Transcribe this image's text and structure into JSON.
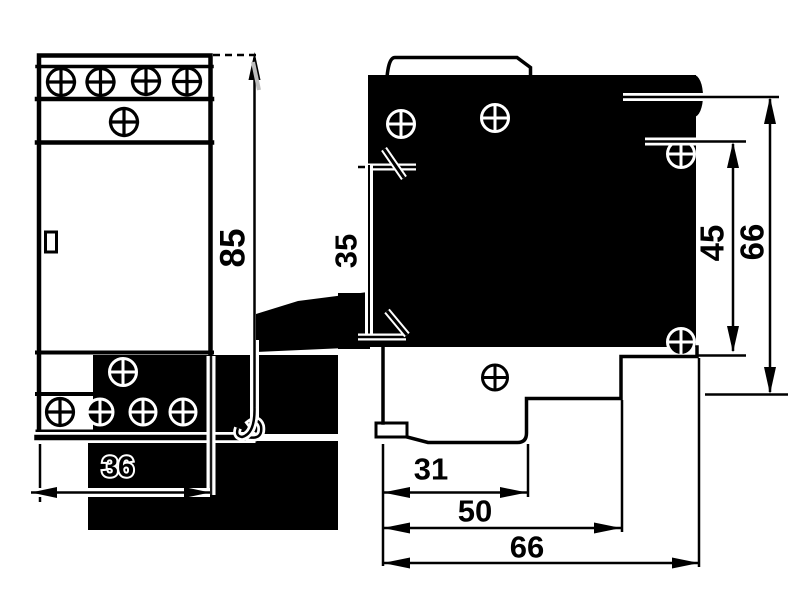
{
  "drawing": {
    "views": {
      "front_view": "front-view",
      "side_view": "side-view"
    },
    "labels": {
      "front_height": "85",
      "front_width": "36",
      "side_body_height": "35",
      "side_mount_height": "45",
      "side_total_height": "66",
      "side_depth_inner": "31",
      "side_depth_mid": "50",
      "side_depth_total": "66"
    },
    "colors": {
      "ink": "#000000",
      "paper": "#ffffff"
    }
  }
}
